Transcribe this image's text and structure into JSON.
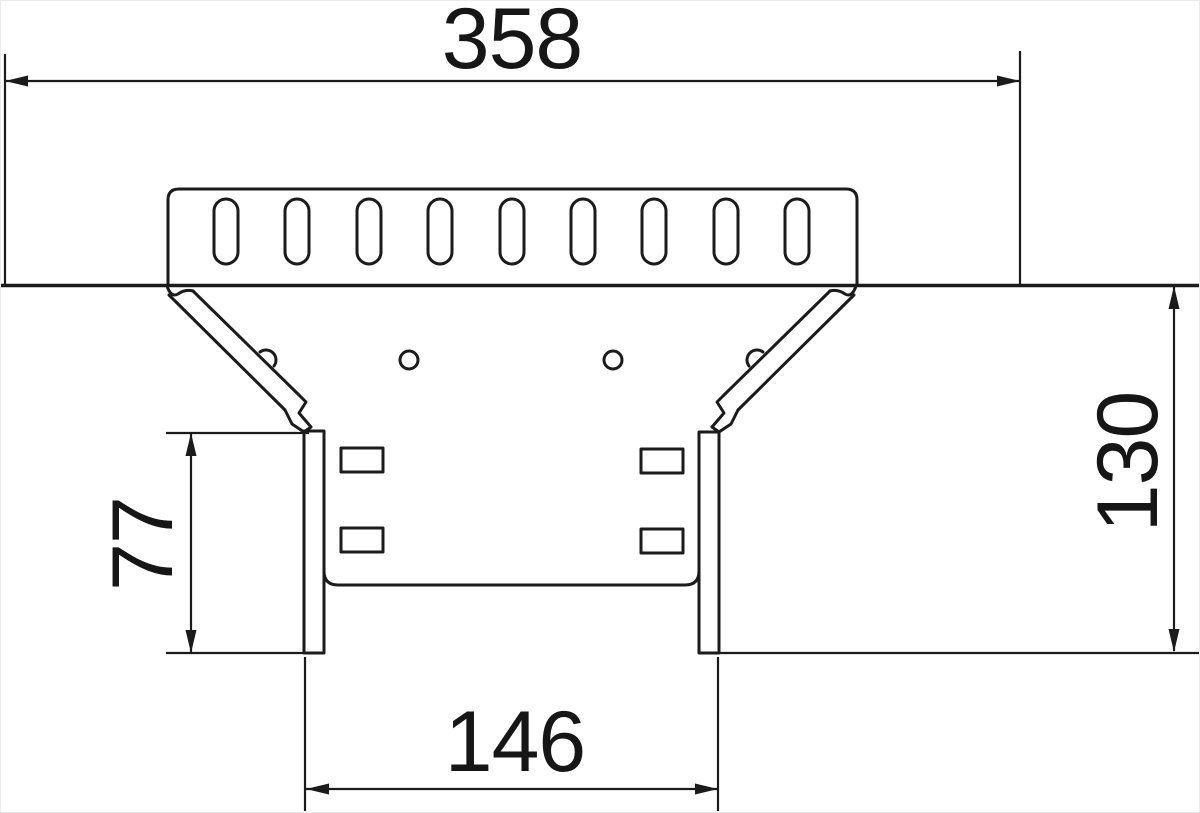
{
  "drawing": {
    "kind": "cable-tray-tee-branch-dimension-drawing",
    "view": "top-view",
    "dimensions": {
      "overall_length": "358",
      "branch_depth": "130",
      "branch_side_length": "77",
      "branch_width": "146"
    },
    "features": {
      "top_plate_slot_count": 9,
      "branch_side_slot_count": 4,
      "round_hole_count": 2,
      "transition_angle_deg": 45
    },
    "colors": {
      "line": "#1b1b1b",
      "background": "#ffffff"
    }
  }
}
